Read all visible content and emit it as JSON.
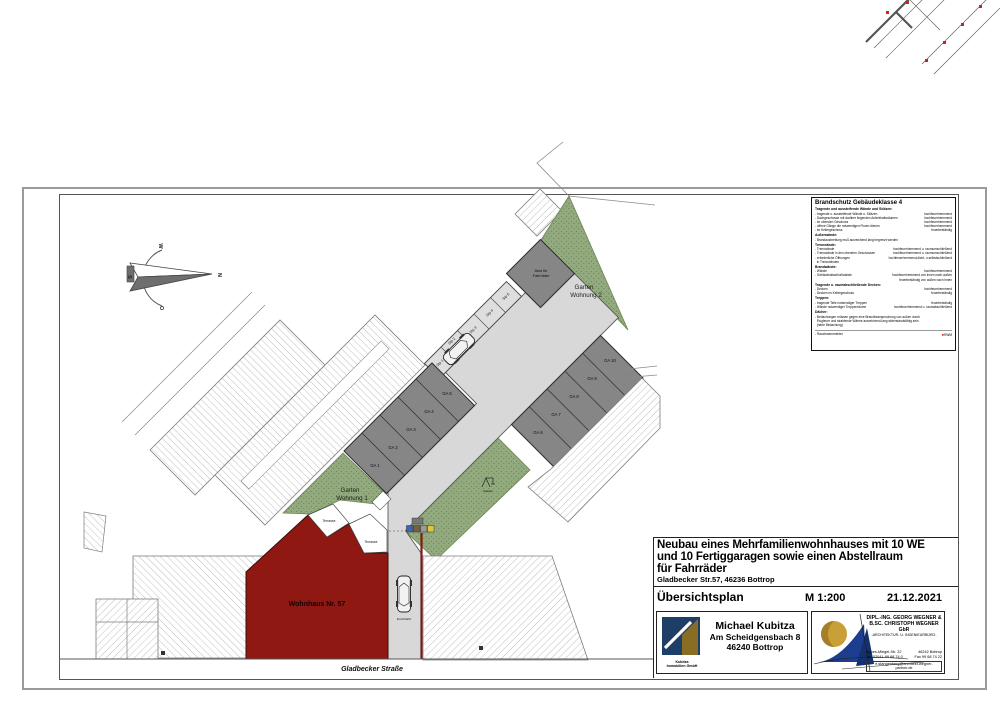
{
  "colors": {
    "red_building": "#8f1812",
    "garage_gray": "#868686",
    "pavement": "#d8d8d8",
    "green": "#92aa7d",
    "marker_red": "#cc2222",
    "logo_navy": "#1d3e66",
    "logo_gold": "#c99f37"
  },
  "compass": {
    "n": "N",
    "w": "W",
    "s": "S",
    "o": "O"
  },
  "plan": {
    "wohnhaus_label": "Wohnhaus Nr. 57",
    "garden1_line1": "Garten",
    "garden1_line2": "Wohnung 1",
    "garden2_line1": "Garten",
    "garden2_line2": "Wohnung 2",
    "terrace1": "Terrasse",
    "terrace2": "Terrasse",
    "bike_line1": "Abst für",
    "bike_line2": "Fahrräder",
    "durchfahrt": "Durchfahrt",
    "spielen": "Spielen",
    "street": "Gladbecker Straße",
    "garages": [
      "GA 1",
      "GA 2",
      "GA 3",
      "GA 4",
      "GA 5",
      "GA 6",
      "GA 7",
      "GA 8",
      "GA 9",
      "GA 10"
    ],
    "stellplaetze": [
      "Stp 1",
      "Stp 2",
      "Stp 3",
      "Stp 4",
      "Stp 5"
    ]
  },
  "fire": {
    "title": "Brandschutz Gebäudeklasse 4",
    "sections": [
      {
        "title": "Tragende und aussteifende Wände und Stützen:",
        "items": [
          [
            "- tragende u. aussteifende Wände u. Stützen",
            "hochfeuerhemmend"
          ],
          [
            "- Dachgeschosse mit darüber liegenden Aufenthaltsräumen",
            "hochfeuerhemmend"
          ],
          [
            "- im obersten Geschoss",
            "hochfeuerhemmend"
          ],
          [
            "- offene Gänge die notwendigen Fluren dienen",
            "hochfeuerhemmend"
          ],
          [
            "- im Kellergeschoss",
            "feuerbeständig"
          ]
        ]
      },
      {
        "title": "Außenwände:",
        "items": [
          [
            "- Brandausbreitung muß ausreichend lang begrenzt werden",
            ""
          ]
        ]
      },
      {
        "title": "Trennwände:",
        "items": [
          [
            "- Trennwände",
            "hochfeuerhemmend u. raumumschließend"
          ],
          [
            "- Trennwände in den obersten Geschossen",
            "hochfeuerhemmend u. raumumschließend"
          ],
          [
            "- erforderliche Öffnungen",
            "hochfeuerhemmend,dicht- u.selbstschließend"
          ],
          [
            "  in Trennwänden",
            ""
          ]
        ]
      },
      {
        "title": "Brandwände:",
        "items": [
          [
            "- Wände",
            "hochfeuerhemmend"
          ],
          [
            "- Gebäudeabschlußwände",
            "hochfeuerhemmend von innen nach außen"
          ],
          [
            "",
            "feuerbeständig von außen nach innen"
          ]
        ]
      },
      {
        "title": "Tragende u. raumabschließende Decken:",
        "items": [
          [
            "- Decken",
            "hochfeuerhemmend"
          ],
          [
            "- Decken im Kellergeschoss",
            "feuerbeständig"
          ]
        ]
      },
      {
        "title": "Treppen:",
        "items": [
          [
            "- tragende Teile notwendiger Treppen",
            "feuerbeständig"
          ],
          [
            "- Wände notwendiger Treppenräume",
            "hochfeuerhemmend u. raumabschließend"
          ]
        ]
      },
      {
        "title": "Dächer:",
        "items": [
          [
            "- Bedachungen müssen gegen eine Brandbeanspruchung von außen durch",
            ""
          ],
          [
            "  Flugfeuer und strahlende Wärme ausreichend lang widerstandsfähig sein",
            ""
          ],
          [
            "  (harte Bedachung)",
            ""
          ]
        ]
      }
    ],
    "footer_left": "- Rauchwarnmelder",
    "footer_right": "RWM"
  },
  "titleblock": {
    "project_line1": "Neubau eines Mehrfamilienwohnhauses mit 10 WE",
    "project_line2": "und 10 Fertiggaragen sowie einen Abstellraum",
    "project_line3": "für Fahrräder",
    "address": "Gladbecker Str.57, 46236 Bottrop",
    "plan_name": "Übersichtsplan",
    "scale": "M 1:200",
    "date": "21.12.2021",
    "client": {
      "name": "Michael Kubitza",
      "street": "Am Scheidgensbach 8",
      "city": "46240 Bottrop",
      "logo_line1": "Kubitza",
      "logo_line2": "Immobilien GmbH"
    },
    "architect": {
      "line1": "DIPL.-ING. GEORG WEGNER &",
      "line2": "B.SC. CHRISTOPH WEGNER GbR",
      "line3": "-ARCHITEKTUR- U. INGENIEURBÜRO-",
      "street": "Agnes-Miegel-Str. 22",
      "city": "46242 Bottrop",
      "tel": "Tel. 02041-99 68 74 0",
      "fax": "Fax 99 68 74 22",
      "email": "e.stangenberg@architekt-wegner-partner.de"
    }
  }
}
